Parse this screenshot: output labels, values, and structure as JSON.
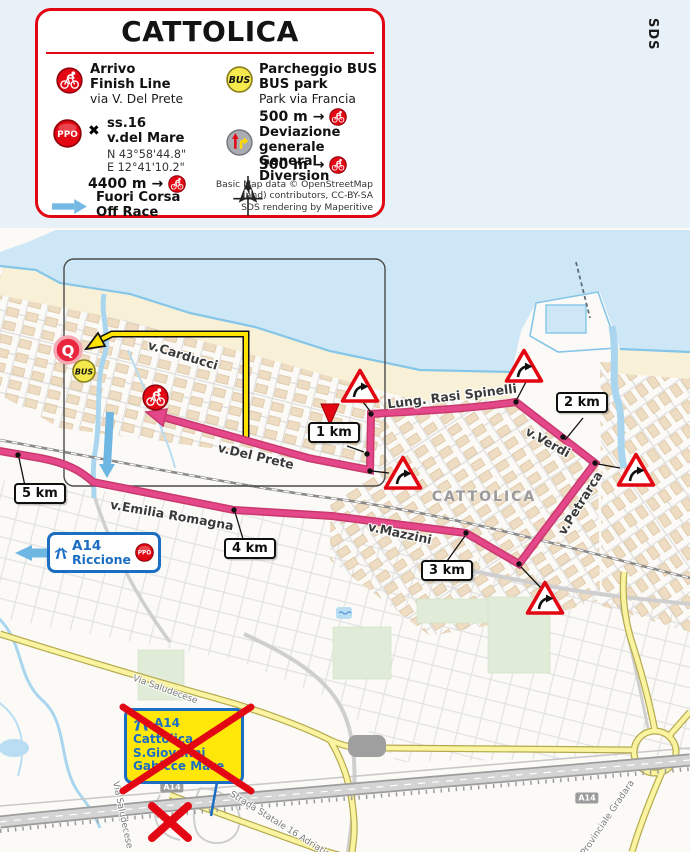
{
  "watermark": "SDS",
  "legend": {
    "title": "CATTOLICA",
    "finish": {
      "title1": "Arrivo",
      "title2": "Finish Line",
      "subtitle": "via V. Del Prete"
    },
    "ppo": {
      "badge": "PPO",
      "cross": "✖",
      "title1": "ss.16",
      "title2": "v.del Mare",
      "lat": "N 43°58'44.8\"",
      "lon": "E 12°41'10.2\"",
      "distance": "4400 m",
      "arrow": "→"
    },
    "offrace": {
      "title1": "Fuori Corsa",
      "title2": "Off Race"
    },
    "buspark": {
      "badge": "BUS",
      "title1": "Parcheggio BUS",
      "title2": "BUS park",
      "subtitle": "Park via Francia",
      "distance": "500 m",
      "arrow": "→"
    },
    "diversion": {
      "title1": "Deviazione generale",
      "title2": "General Diversion",
      "distance": "300 m",
      "arrow": "→"
    },
    "north_letter": "N",
    "credits": {
      "line1": "Basic Map data © OpenStreetMap",
      "line2": "(and) contributors, CC-BY-SA",
      "line3": "SDS rendering by Maperitive"
    }
  },
  "map": {
    "city": "CATTOLICA",
    "km_markers": {
      "km5": "5 km",
      "km4": "4 km",
      "km3": "3 km",
      "km2": "2 km",
      "km1": "1 km"
    },
    "streets": {
      "carducci": "v.Carducci",
      "delprete": "v.Del Prete",
      "lungomare": "Lung. Rasi Spinelli",
      "verdi": "v.Verdi",
      "petrarca": "v.Petrarca",
      "mazzini": "v.Mazzini",
      "emilia": "v.Emilia Romagna",
      "saludecese_a": "Via Saludecese",
      "saludecese_b": "Via Saludecese",
      "ss16": "Strada Statale 16 Adriatica",
      "gradara": "Provinciale Gradara"
    },
    "highway_shield": "A14",
    "icons": {
      "quartiere": "Q",
      "bus": "BUS"
    },
    "signs": {
      "riccione": {
        "road": "A14",
        "destination": "Riccione",
        "badge": "PPO"
      },
      "closed_exit": {
        "road": "A14",
        "line1": "Cattolica",
        "line2": "S.Giovanni",
        "line3": "Gabicce Mare"
      }
    }
  },
  "colors": {
    "route_pink": "#e5488a",
    "route_casing": "#c9396f",
    "deviation_yellow": "#ffe400",
    "offrace_blue": "#6fb7e3",
    "legend_red": "#e30613",
    "sea": "#cde7f6",
    "beach": "#f8f1d7",
    "sign_blue": "#1b6ec2",
    "sign_yellow": "#ffe70a"
  }
}
